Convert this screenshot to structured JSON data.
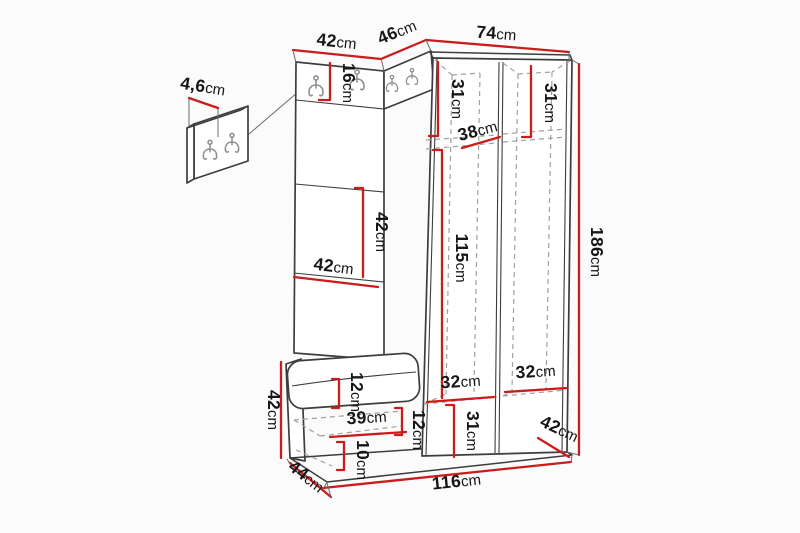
{
  "figure": {
    "kind": "furniture dimension drawing",
    "unit": "cm",
    "wall_panel_hooks": 2,
    "unit_hooks": 4
  },
  "colors": {
    "dimension_red": "#cc1b1b",
    "outline_dark": "#3d3d3d",
    "dash_gray": "#a0a0a0",
    "background": "#fbfbfb",
    "text": "#161616"
  },
  "dimensions": {
    "panel_thickness": {
      "value": "4,6",
      "unit": "cm"
    },
    "top_left_width": {
      "value": "42",
      "unit": "cm"
    },
    "corner_width": {
      "value": "46",
      "unit": "cm"
    },
    "right_width": {
      "value": "74",
      "unit": "cm"
    },
    "hook_strip_height": {
      "value": "16",
      "unit": "cm"
    },
    "left_col_top_height": {
      "value": "31",
      "unit": "cm"
    },
    "right_col_top_height": {
      "value": "31",
      "unit": "cm"
    },
    "shelf_depth": {
      "value": "38",
      "unit": "cm"
    },
    "interior_height": {
      "value": "115",
      "unit": "cm"
    },
    "total_height": {
      "value": "186",
      "unit": "cm"
    },
    "mirror_height": {
      "value": "42",
      "unit": "cm"
    },
    "panel_width": {
      "value": "42",
      "unit": "cm"
    },
    "bench_height": {
      "value": "42",
      "unit": "cm"
    },
    "cushion_thickness": {
      "value": "12",
      "unit": "cm"
    },
    "gap_height": {
      "value": "12",
      "unit": "cm"
    },
    "bench_interior_width": {
      "value": "39",
      "unit": "cm"
    },
    "base_height": {
      "value": "10",
      "unit": "cm"
    },
    "bench_depth": {
      "value": "44",
      "unit": "cm"
    },
    "total_width": {
      "value": "116",
      "unit": "cm"
    },
    "left_col_width": {
      "value": "32",
      "unit": "cm"
    },
    "right_col_width": {
      "value": "32",
      "unit": "cm"
    },
    "bottom_section_height": {
      "value": "31",
      "unit": "cm"
    },
    "wardrobe_depth": {
      "value": "42",
      "unit": "cm"
    }
  }
}
